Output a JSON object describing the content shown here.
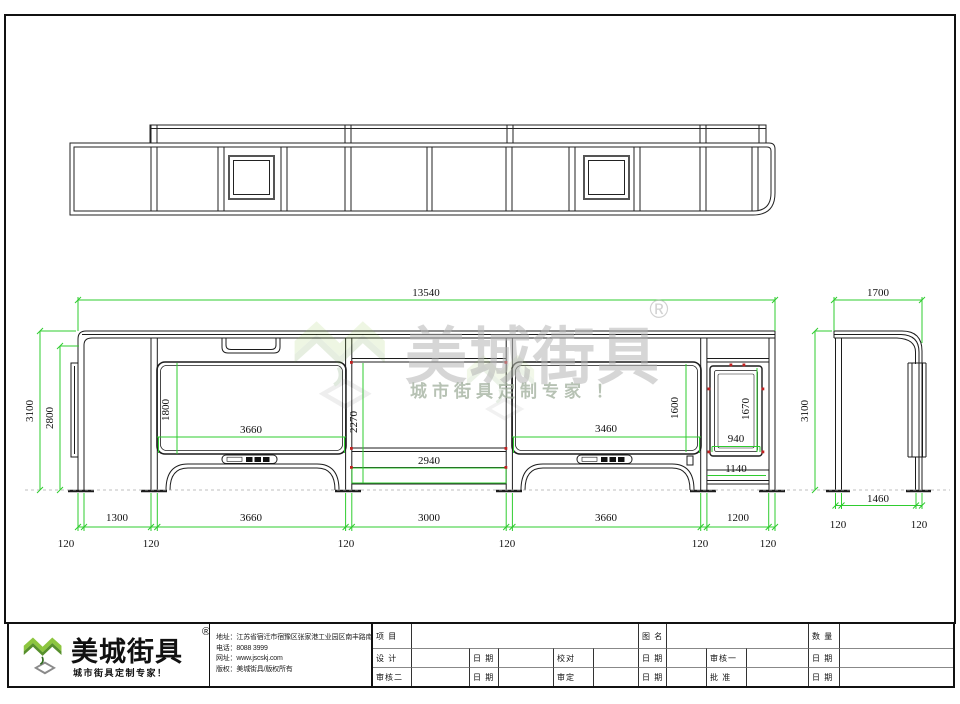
{
  "watermark": {
    "brand": "美城街具",
    "registered": "®",
    "tagline": "城市街具定制专家 ！"
  },
  "front_view": {
    "total_width": "13540",
    "height": "3100",
    "clear_height": "2800",
    "panel1_width": "3660",
    "panel1_height": "1800",
    "mid_height": "2270",
    "mid_width": "2940",
    "panel2_width": "3460",
    "panel2_height": "1600",
    "lightbox_height": "1670",
    "lightbox_width": "940",
    "lightbox_base_width": "1140",
    "chain": [
      "1300",
      "3660",
      "3000",
      "3660",
      "1200"
    ],
    "post_width": "120"
  },
  "side_view": {
    "roof_width": "1700",
    "height": "3100",
    "post_spacing": "1460",
    "post_width": "120"
  },
  "title_block": {
    "brand": "美城街具",
    "registered": "®",
    "tagline": "城市街具定制专家！",
    "info_lines": [
      "地址：江苏省宿迁市宿豫区张家港工业园区南丰路南侧1号",
      "电话：8088 3999",
      "网址：www.jscskj.com",
      "版权：美城街具/版权所有"
    ],
    "labels": {
      "project": "项 目",
      "drawing_name": "图 名",
      "quantity": "数 量",
      "design": "设 计",
      "date": "日 期",
      "proofread": "校对",
      "reviewer1": "审核一",
      "reviewer2": "审核二",
      "verify": "审定",
      "approve": "批 准"
    }
  }
}
